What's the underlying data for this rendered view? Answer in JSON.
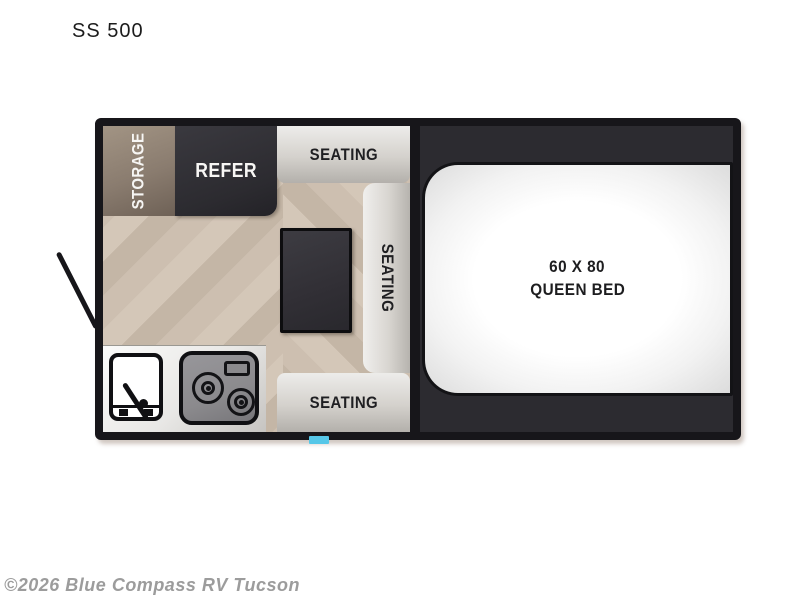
{
  "page": {
    "model_title": "SS 500",
    "watermark": "©2026 Blue Compass RV Tucson"
  },
  "floorplan": {
    "labels": {
      "storage": "STORAGE",
      "refer": "REFER",
      "seating_top": "SEATING",
      "seating_side": "SEATING",
      "seating_bottom": "SEATING",
      "bed_line1": "60 X 80",
      "bed_line2": "QUEEN BED"
    },
    "icons": [
      "sink-icon",
      "stove-icon",
      "door-swing-line",
      "entry-step"
    ],
    "colors": {
      "wall": "#17161a",
      "floor_light": "#d4c7b8",
      "floor_dark": "#c4b6a6",
      "storage_cabinet": "#8a7c6f",
      "dark_cabinet": "#2c2b30",
      "seating_light": "#edecea",
      "seating_dark": "#b3b0ab",
      "bed_area_background": "#2c2b30",
      "bed_fill": "#ffffff",
      "counter": "#e8e7e5",
      "stove": "#8b8a8d",
      "entry_step": "#56c7e8",
      "watermark_text": "#9c9c9c"
    }
  }
}
